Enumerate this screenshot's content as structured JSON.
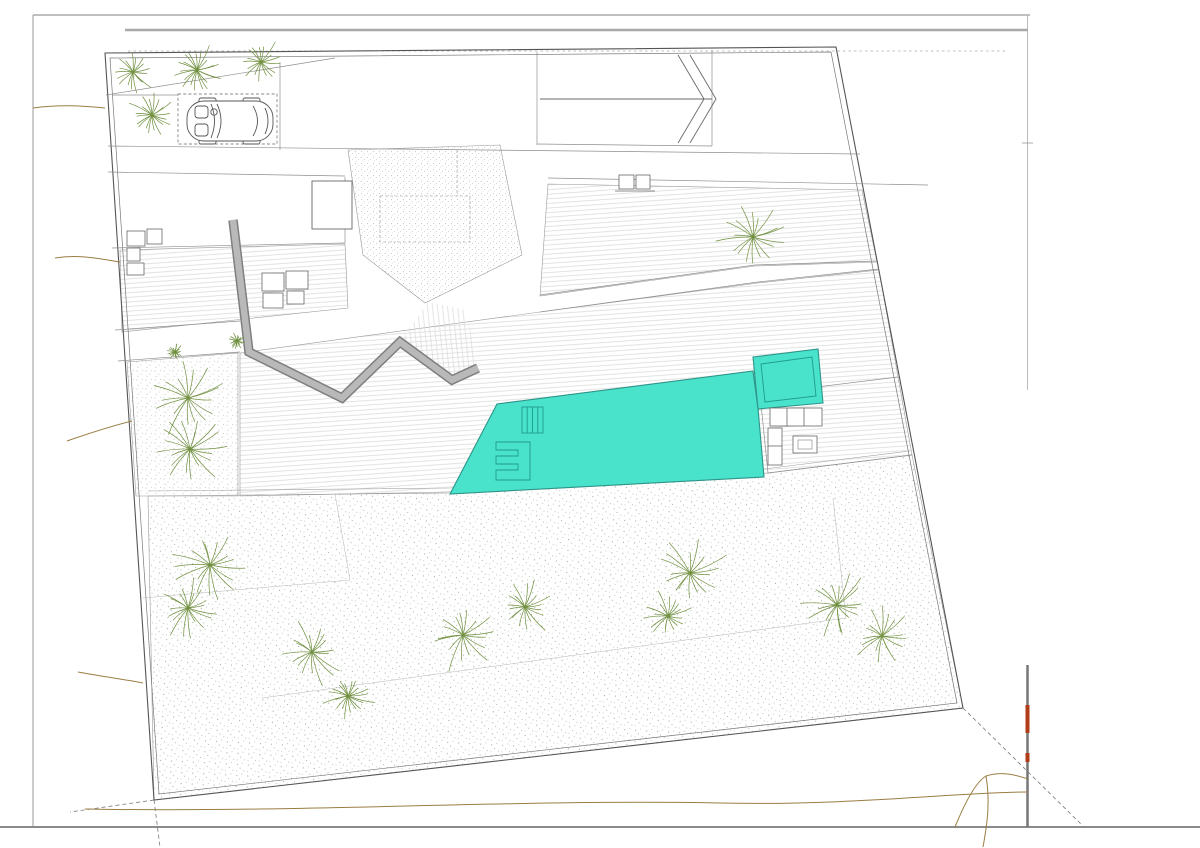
{
  "meta": {
    "drawing_type": "architectural site plan",
    "language": "es"
  },
  "colors": {
    "pool": "#49E2CB",
    "pool_edge": "#2E9488",
    "bush": "#57B4B2",
    "bush_fill": "#E4F4F2",
    "palm": "#6F8F3E",
    "round_tree": "#9FBB78",
    "round_tree_light": "#BFD0A0",
    "faint_tree": "#CCD6BA",
    "contour": "#9A7D42",
    "wall_gray": "#9B9B9B",
    "line": "#8A8A8A",
    "text": "#3C3C3C",
    "accent_red": "#B23C17"
  },
  "labels": [
    {
      "id": "lv-169",
      "text": "169,00",
      "x": 175,
      "y": 77,
      "size": 11,
      "rot": -4
    },
    {
      "id": "lv-168",
      "text": "168,00",
      "x": 143,
      "y": 123,
      "size": 11,
      "rot": -4
    },
    {
      "id": "lv-166-80-top",
      "text": "166,80",
      "x": 414,
      "y": 116,
      "size": 11,
      "rot": 0
    },
    {
      "id": "lv-168-50",
      "text": "168,50",
      "x": 775,
      "y": 71,
      "size": 11,
      "rot": 0
    },
    {
      "id": "ramp-title",
      "text": "Rampa",
      "x": 620,
      "y": 95,
      "size": 10,
      "rot": 0
    },
    {
      "id": "ramp-slope",
      "text": "pte: 18%",
      "x": 622,
      "y": 112,
      "size": 10,
      "rot": 0
    },
    {
      "id": "lv-166-90",
      "text": "166,90",
      "x": 167,
      "y": 159,
      "size": 10.5,
      "rot": -3
    },
    {
      "id": "lv-165-90-r",
      "text": "165,90",
      "x": 634,
      "y": 162,
      "size": 10.5,
      "rot": -3
    },
    {
      "id": "lv-165-90-l",
      "text": "165,90",
      "x": 177,
      "y": 190,
      "size": 10.5,
      "rot": -3
    },
    {
      "id": "lv-163-50-r",
      "text": "163,50",
      "x": 587,
      "y": 219,
      "size": 10.5,
      "rot": -3
    },
    {
      "id": "lv-163-50-l",
      "text": "163,50",
      "x": 197,
      "y": 287,
      "size": 11,
      "rot": -3
    },
    {
      "id": "lv-162-20-r",
      "text": "162,20",
      "x": 664,
      "y": 286,
      "size": 10.5,
      "rot": -8
    },
    {
      "id": "lv-162-20-l",
      "text": "162,20",
      "x": 182,
      "y": 347,
      "size": 10.5,
      "rot": -3
    },
    {
      "id": "lv-160-20",
      "text": "160,20",
      "x": 295,
      "y": 428,
      "size": 11,
      "rot": -3
    },
    {
      "id": "lv-158-60",
      "text": "158,60",
      "x": 859,
      "y": 446,
      "size": 11,
      "rot": -3
    },
    {
      "id": "lv-156-00",
      "text": "156,00",
      "x": 841,
      "y": 489,
      "size": 11,
      "rot": -3
    },
    {
      "id": "lv-170-10",
      "text": "170,10",
      "x": 421,
      "y": 190,
      "size": 6.5,
      "rot": 0,
      "boxed": true
    },
    {
      "id": "lv-171-30",
      "text": "171,30",
      "x": 332,
      "y": 216,
      "size": 6.5,
      "rot": 0,
      "boxed": true
    },
    {
      "id": "lv-166-80-roof",
      "text": "166,80",
      "x": 406,
      "y": 290,
      "size": 6,
      "rot": 0,
      "boxed": true
    },
    {
      "id": "eq-hvac",
      "text": "Maquinaria Climatización",
      "x": 264,
      "y": 206,
      "size": 4.3,
      "rot": 0,
      "tiny": true
    },
    {
      "id": "eq-cook-1",
      "text": "Cocción",
      "x": 332,
      "y": 198,
      "size": 4.6,
      "rot": 0,
      "tiny": true
    },
    {
      "id": "eq-cook-2",
      "text": "exterior",
      "x": 332,
      "y": 204,
      "size": 4.6,
      "rot": 0,
      "tiny": true
    },
    {
      "id": "eq-panels",
      "text": "PANELES ACS",
      "x": 405,
      "y": 200,
      "size": 4.8,
      "rot": -2,
      "tiny": true
    }
  ],
  "planting": {
    "palms": [
      [
        133,
        72,
        24
      ],
      [
        197,
        70,
        28
      ],
      [
        261,
        62,
        25
      ],
      [
        152,
        115,
        26
      ],
      [
        753,
        237,
        38
      ],
      [
        188,
        398,
        42
      ],
      [
        190,
        449,
        38
      ],
      [
        175,
        352,
        9
      ],
      [
        237,
        341,
        9
      ],
      [
        210,
        565,
        40
      ],
      [
        188,
        608,
        33
      ],
      [
        312,
        652,
        36
      ],
      [
        348,
        696,
        28
      ],
      [
        463,
        635,
        42
      ],
      [
        525,
        607,
        33
      ],
      [
        690,
        573,
        42
      ],
      [
        668,
        616,
        28
      ],
      [
        837,
        605,
        38
      ],
      [
        882,
        636,
        32
      ]
    ],
    "round_trees": [
      [
        165,
        200,
        36,
        0
      ],
      [
        700,
        214,
        44,
        1
      ],
      [
        312,
        552,
        38,
        1
      ],
      [
        583,
        543,
        40,
        1
      ],
      [
        233,
        727,
        40,
        1
      ],
      [
        595,
        678,
        38,
        1
      ],
      [
        788,
        678,
        42,
        1
      ],
      [
        1055,
        537,
        28,
        2
      ]
    ],
    "bush_pairs": [
      [
        123,
        158,
        8
      ],
      [
        188,
        155,
        8
      ],
      [
        222,
        153,
        8
      ],
      [
        256,
        151,
        8
      ],
      [
        630,
        160,
        8
      ],
      [
        668,
        158,
        8
      ],
      [
        702,
        156,
        8
      ],
      [
        736,
        154,
        8
      ],
      [
        143,
        351,
        7
      ],
      [
        205,
        345,
        7
      ]
    ],
    "scrub_row": [
      [
        556,
        301
      ],
      [
        580,
        297
      ],
      [
        604,
        293
      ],
      [
        628,
        289
      ],
      [
        652,
        286
      ],
      [
        676,
        282
      ],
      [
        700,
        278
      ],
      [
        724,
        275
      ]
    ]
  },
  "stairs": [
    {
      "x": 558,
      "y": 149,
      "w": 66,
      "h": 22,
      "rot": -1.5,
      "dir": "v",
      "gap": 5,
      "t1": 4,
      "t2": 64,
      "arrow": {
        "a1": 62,
        "a2": 6
      }
    },
    {
      "x": 758,
      "y": 152,
      "w": 166,
      "h": 27,
      "rot": -1,
      "dir": "v",
      "gap": 5.5,
      "t1": 90,
      "t2": 164,
      "arrow": {
        "a1": 160,
        "a2": 8
      }
    },
    {
      "x": 781,
      "y": 221,
      "w": 57,
      "h": 23,
      "rot": 13,
      "dir": "v",
      "gap": 5,
      "t1": 3,
      "t2": 55
    },
    {
      "x": 806,
      "y": 247,
      "w": 62,
      "h": 25,
      "rot": 8,
      "dir": "v",
      "gap": 5,
      "t1": 3,
      "t2": 60,
      "arrow": {
        "a1": 6,
        "a2": 56
      }
    },
    {
      "x": 872,
      "y": 384,
      "w": 26,
      "h": 48,
      "rot": 14,
      "dir": "h",
      "gap": 5,
      "t1": 3,
      "t2": 46,
      "arrow": {
        "a1": 44,
        "a2": 6
      }
    },
    {
      "x": 897,
      "y": 466,
      "w": 27,
      "h": 72,
      "rot": 10,
      "dir": "h",
      "gap": 5,
      "t1": 3,
      "t2": 70,
      "arrow": {
        "a1": 66,
        "a2": 7
      }
    }
  ],
  "equipment": {
    "hvac_units": {
      "w": 29,
      "h": 18,
      "positions": [
        [
          233,
          185
        ],
        [
          266,
          185
        ],
        [
          233,
          207
        ],
        [
          266,
          207
        ]
      ]
    },
    "solar_panels": {
      "w": 15,
      "h": 32,
      "y": 203,
      "xs": [
        387,
        408,
        428,
        448
      ]
    },
    "loungers": {
      "w": 20,
      "h": 38,
      "positions": [
        [
          592,
          371,
          -8
        ],
        [
          624,
          365,
          -8
        ],
        [
          656,
          359,
          -8
        ]
      ]
    },
    "side_tables": [
      [
        608,
        352,
        11,
        13
      ],
      [
        640,
        346,
        11,
        13
      ]
    ]
  }
}
